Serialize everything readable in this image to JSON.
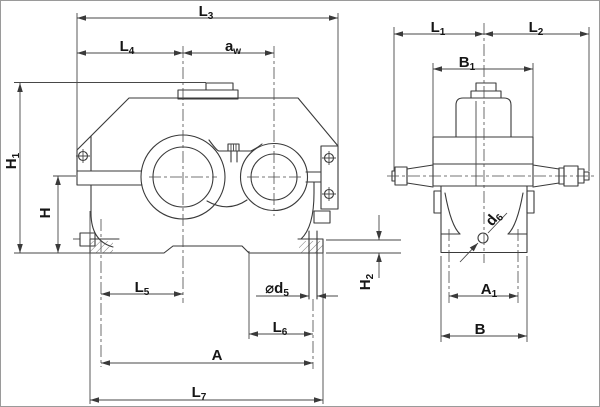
{
  "drawing": {
    "description": "Two-view dimensioned outline drawing of a gear reducer (front view and side view)",
    "colors": {
      "background": "#ffffff",
      "line": "#3a3a3a",
      "dimension_line": "#474747",
      "label_text": "#151515"
    }
  },
  "labels": {
    "L3": {
      "main": "L",
      "sub": "3"
    },
    "L4": {
      "main": "L",
      "sub": "4"
    },
    "aw": {
      "main": "a",
      "sub": "w"
    },
    "H1": {
      "main": "H",
      "sub": "1"
    },
    "H": {
      "main": "H",
      "sub": ""
    },
    "L5": {
      "main": "L",
      "sub": "5"
    },
    "d5": {
      "main": "⌀d",
      "sub": "5"
    },
    "L6": {
      "main": "L",
      "sub": "6"
    },
    "A": {
      "main": "A",
      "sub": ""
    },
    "L7": {
      "main": "L",
      "sub": "7"
    },
    "H2": {
      "main": "H",
      "sub": "2"
    },
    "L1": {
      "main": "L",
      "sub": "1"
    },
    "L2": {
      "main": "L",
      "sub": "2"
    },
    "B1": {
      "main": "B",
      "sub": "1"
    },
    "A1": {
      "main": "A",
      "sub": "1"
    },
    "B": {
      "main": "B",
      "sub": ""
    },
    "d6": {
      "main": "d",
      "sub": "6"
    }
  }
}
